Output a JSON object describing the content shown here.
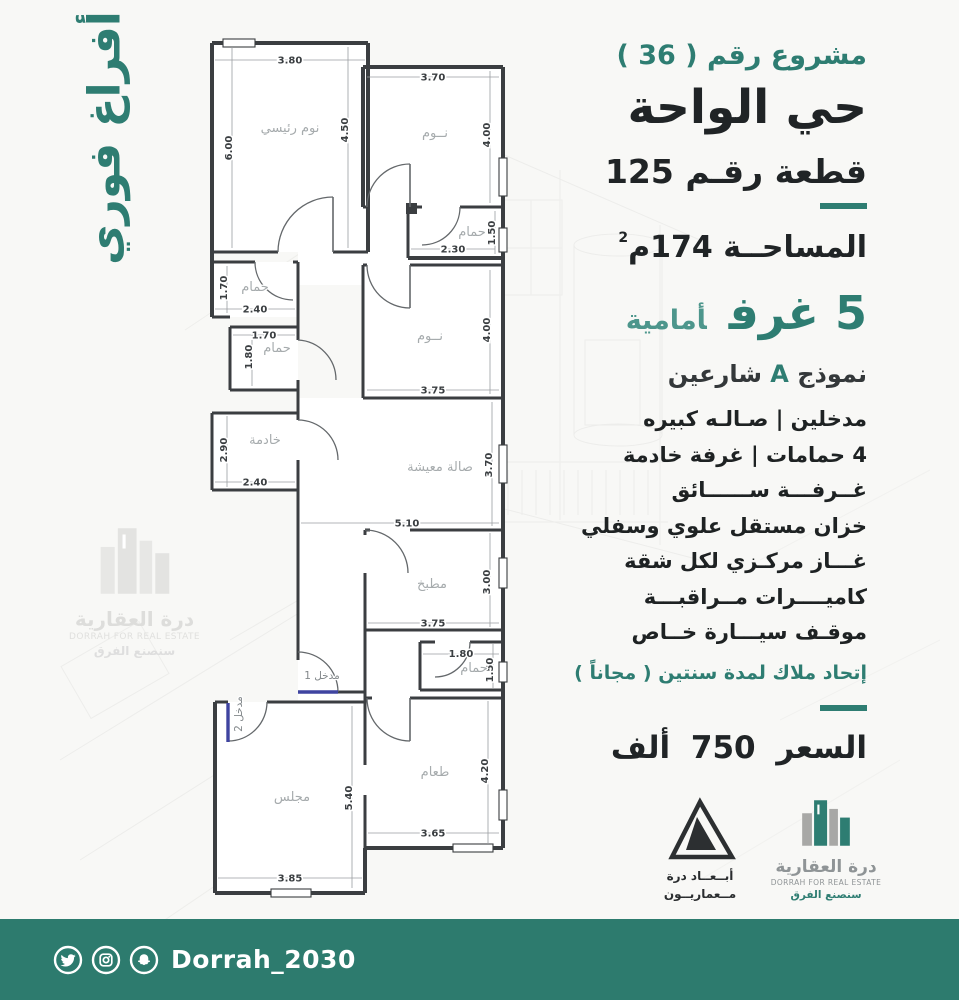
{
  "colors": {
    "accent": "#2e7d72",
    "footer_bar": "#2d7b6e",
    "dark_text": "#202426",
    "entry_door": "#3f44a0",
    "wall": "#3b3e41",
    "room_label": "#a6abad"
  },
  "side_banner": {
    "text": "أفراغ فوري"
  },
  "right_panel": {
    "project_no": "مشروع رقم ( 36 )",
    "district": "حي الواحة",
    "plot": "قطعة رقـم 125",
    "area_label": "المساحــة 174م",
    "area_sup": "2",
    "rooms_big": "5 غرف",
    "rooms_small": "أمامية",
    "model_pre": "نموذج",
    "model_letter": "A",
    "model_post": "شارعين",
    "features": [
      "مدخلين  |  صـالـه كبيره",
      "4 حمامات | غرفة خادمة",
      "غــرفـــة ســــــائق",
      "خزان مستقل علوي وسفلي",
      "غـــاز مركـزي لكل شقة",
      "كاميــــرات مــراقبـــة",
      "موقـف سيـــارة خــاص"
    ],
    "union_note": "إتحاد ملاك لمدة سنتين ( مجاناً )",
    "price": "السعر 750 ألف"
  },
  "floorplan": {
    "mb": {
      "name": "نوم رئيسي",
      "top": "3.80",
      "right": "4.50",
      "left": "6.00"
    },
    "bed2": {
      "name": "نــوم",
      "top": "3.70",
      "right": "4.00"
    },
    "bath_top": {
      "name": "حمام",
      "right": "1.50",
      "bottom": "2.30"
    },
    "bath1": {
      "name": "حمام",
      "left": "1.70",
      "bottom": "2.40"
    },
    "bath2": {
      "name": "حمام",
      "top": "1.70",
      "left": "1.80"
    },
    "maid": {
      "name": "خادمة",
      "left": "2.90",
      "bottom": "2.40"
    },
    "bed3": {
      "name": "نــوم",
      "right": "4.00",
      "bottom": "3.75"
    },
    "living": {
      "name": "صالة معيشة",
      "right": "3.70",
      "width": "5.10"
    },
    "kitchen": {
      "name": "مطبخ",
      "right": "3.00",
      "bottom": "3.75"
    },
    "bath3": {
      "name": "حمام",
      "top": "1.80",
      "right": "1.50"
    },
    "entry1": {
      "name": "مدخل 1"
    },
    "entry2": {
      "name": "مدخل 2"
    },
    "majlis": {
      "name": "مجلس",
      "mid": "5.40",
      "bottom": "3.85"
    },
    "dining": {
      "name": "طعام",
      "right": "4.20",
      "bottom": "3.65"
    }
  },
  "logos": {
    "abaad": {
      "line1": "أبــعــاد درة",
      "line2": "مــعماريــون"
    },
    "dorrah": {
      "name_ar": "درة العقارية",
      "name_en": "DORRAH FOR REAL ESTATE",
      "slogan": "سنصنع الفرق"
    }
  },
  "watermark": {
    "name_ar": "درة العقارية",
    "name_en": "DORRAH FOR REAL ESTATE",
    "slogan": "سنصنع الفرق"
  },
  "footer": {
    "handle": "Dorrah_2030",
    "icons": [
      "twitter-icon",
      "instagram-icon",
      "snapchat-icon"
    ]
  }
}
